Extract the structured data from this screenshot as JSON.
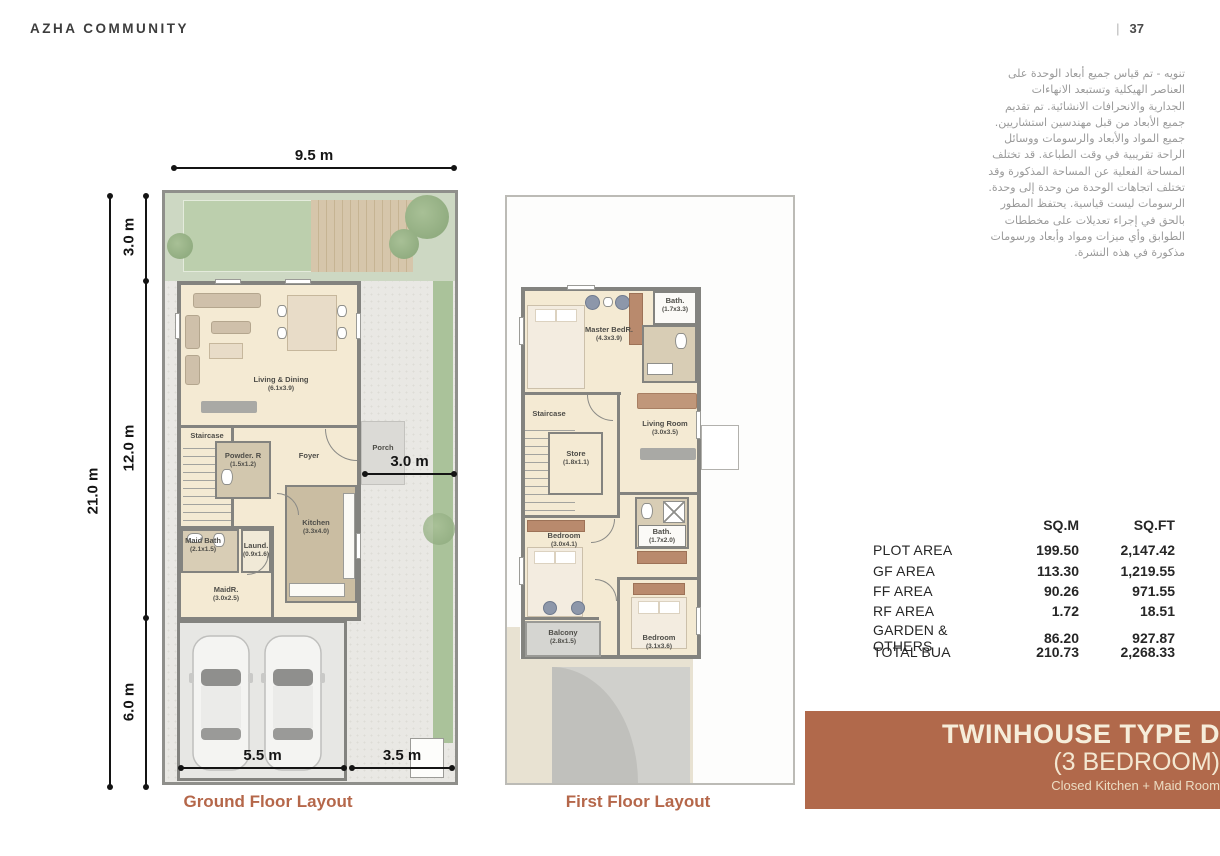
{
  "page": {
    "brand": "AZHA COMMUNITY",
    "page_separator": "|",
    "page_number": "37"
  },
  "disclaimer_ar": "تنويه - تم قياس جميع أبعاد الوحدة على\nالعناصر الهيكلية وتستبعد الانهاءات\nالجدارية والانحرافات الانشائية. تم تقديم\nجميع الأبعاد من قبل مهندسين استشاريين.\nجميع المواد والأبعاد والرسومات ووسائل\nالراحة تقريبية في وقت الطباعة. قد تختلف\nالمساحة الفعلية عن المساحة المذكورة وقد\nتختلف اتجاهات الوحدة من وحدة إلى وحدة.\nالرسومات ليست قياسية. يحتفظ المطور\nبالحق في إجراء تعديلات على مخططات\nالطوابق وأي ميزات ومواد وأبعاد ورسومات\nمذكورة في هذه النشرة.",
  "ground_floor": {
    "caption": "Ground Floor Layout",
    "dim_top": "9.5 m",
    "dim_left_total": "21.0 m",
    "dim_left_a": "3.0 m",
    "dim_left_b": "12.0 m",
    "dim_left_c": "6.0 m",
    "dim_side": "3.0 m",
    "dim_bottom_left": "5.5 m",
    "dim_bottom_right": "3.5 m",
    "rooms": {
      "living": {
        "name": "Living & Dining",
        "size": "(6.1x3.9)"
      },
      "staircase": {
        "name": "Staircase",
        "size": ""
      },
      "foyer": {
        "name": "Foyer",
        "size": ""
      },
      "powder": {
        "name": "Powder. R",
        "size": "(1.5x1.2)"
      },
      "porch": {
        "name": "Porch",
        "size": ""
      },
      "maidbath": {
        "name": "Maid Bath",
        "size": "(2.1x1.5)"
      },
      "laundry": {
        "name": "Laund.",
        "size": "(0.9x1.6)"
      },
      "kitchen": {
        "name": "Kitchen",
        "size": "(3.3x4.0)"
      },
      "maidroom": {
        "name": "MaidR.",
        "size": "(3.0x2.5)"
      }
    }
  },
  "first_floor": {
    "caption": "First Floor Layout",
    "rooms": {
      "master": {
        "name": "Master BedR.",
        "size": "(4.3x3.9)"
      },
      "bath_top": {
        "name": "Bath.",
        "size": "(1.7x3.3)"
      },
      "staircase": {
        "name": "Staircase",
        "size": ""
      },
      "store": {
        "name": "Store",
        "size": "(1.8x1.1)"
      },
      "living": {
        "name": "Living Room",
        "size": "(3.0x3.5)"
      },
      "bath_mid": {
        "name": "Bath.",
        "size": "(1.7x2.0)"
      },
      "bedroom_left": {
        "name": "Bedroom",
        "size": "(3.0x4.1)"
      },
      "bedroom_right": {
        "name": "Bedroom",
        "size": "(3.1x3.6)"
      },
      "balcony": {
        "name": "Balcony",
        "size": "(2.8x1.5)"
      }
    }
  },
  "area_table": {
    "headers": {
      "sqm": "SQ.M",
      "sqft": "SQ.FT"
    },
    "rows": [
      {
        "label": "PLOT AREA",
        "sqm": "199.50",
        "sqft": "2,147.42"
      },
      {
        "label": "GF AREA",
        "sqm": "113.30",
        "sqft": "1,219.55"
      },
      {
        "label": "FF AREA",
        "sqm": "90.26",
        "sqft": "971.55"
      },
      {
        "label": "RF AREA",
        "sqm": "1.72",
        "sqft": "18.51"
      },
      {
        "label": "GARDEN & OTHERS",
        "sqm": "86.20",
        "sqft": "927.87"
      },
      {
        "label": "TOTAL BUA",
        "sqm": "210.73",
        "sqft": "2,268.33"
      }
    ]
  },
  "banner": {
    "title": "TWINHOUSE TYPE D",
    "subtitle": "(3 BEDROOM)",
    "tagline": "Closed Kitchen + Maid Room",
    "bg_color": "#b1694b",
    "text_color": "#f6edda"
  },
  "colors": {
    "accent_terracotta": "#b5674a",
    "room_cream": "#f4ead3",
    "garden_green": "#cdd8c3"
  }
}
